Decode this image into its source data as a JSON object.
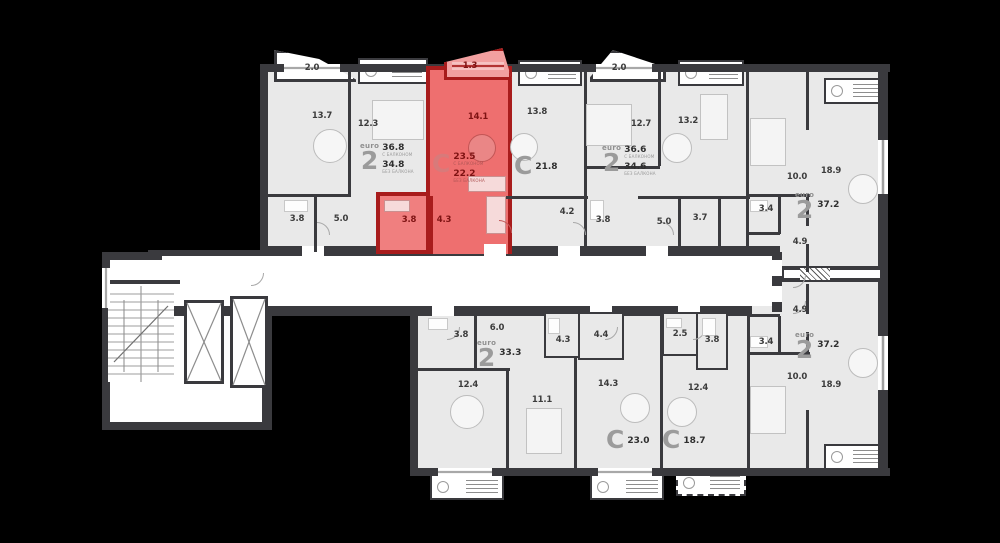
{
  "plan_title": "residential-floor-plan",
  "colors": {
    "background": "#000000",
    "wall": "#3a3a3e",
    "floor": "#e9e9e9",
    "corridor": "#ffffff",
    "highlight_fill": "#ee6f6f",
    "highlight_wall": "#a81c1c"
  },
  "apartments": [
    {
      "name": "euro-2-top-left",
      "type": "euro",
      "type_num": "2",
      "area_with_balcony": "36.8",
      "with_balcony_note": "С БАЛКОНОМ",
      "area": "34.8",
      "area_note": "БЕЗ БАЛКОНА",
      "balcony": "2.0",
      "rooms": [
        "13.7",
        "12.3",
        "3.8",
        "5.0"
      ]
    },
    {
      "name": "studio-highlighted",
      "type": "С",
      "area_with_balcony": "23.5",
      "with_balcony_note": "С БАЛКОНОМ",
      "area": "22.2",
      "area_note": "БЕЗ БАЛКОНА",
      "balcony": "1.3",
      "rooms": [
        "14.1",
        "3.8",
        "4.3"
      ],
      "highlighted": true
    },
    {
      "name": "studio-21-8",
      "type": "С",
      "area": "21.8",
      "rooms": [
        "13.8",
        "4.2",
        "3.8"
      ]
    },
    {
      "name": "euro-2-top-mid",
      "type": "euro",
      "type_num": "2",
      "area_with_balcony": "36.6",
      "with_balcony_note": "С БАЛКОНОМ",
      "area": "34.6",
      "area_note": "БЕЗ БАЛКОНА",
      "balcony": "2.0",
      "rooms": [
        "12.7",
        "13.2",
        "5.0",
        "3.7"
      ]
    },
    {
      "name": "euro-2-right-top",
      "type": "euro",
      "type_num": "2",
      "area": "37.2",
      "rooms": [
        "10.0",
        "18.9",
        "3.4",
        "4.9"
      ]
    },
    {
      "name": "euro-2-right-bottom",
      "type": "euro",
      "type_num": "2",
      "area": "37.2",
      "rooms": [
        "4.9",
        "3.4",
        "10.0",
        "18.9"
      ]
    },
    {
      "name": "euro-2-bottom-left",
      "type": "euro",
      "type_num": "2",
      "area": "33.3",
      "rooms": [
        "3.8",
        "6.0",
        "12.4",
        "11.1"
      ]
    },
    {
      "name": "studio-23-0",
      "type": "С",
      "area": "23.0",
      "rooms": [
        "4.3",
        "4.4",
        "14.3"
      ]
    },
    {
      "name": "studio-18-7",
      "type": "С",
      "area": "18.7",
      "rooms": [
        "2.5",
        "3.8",
        "12.4"
      ]
    }
  ]
}
